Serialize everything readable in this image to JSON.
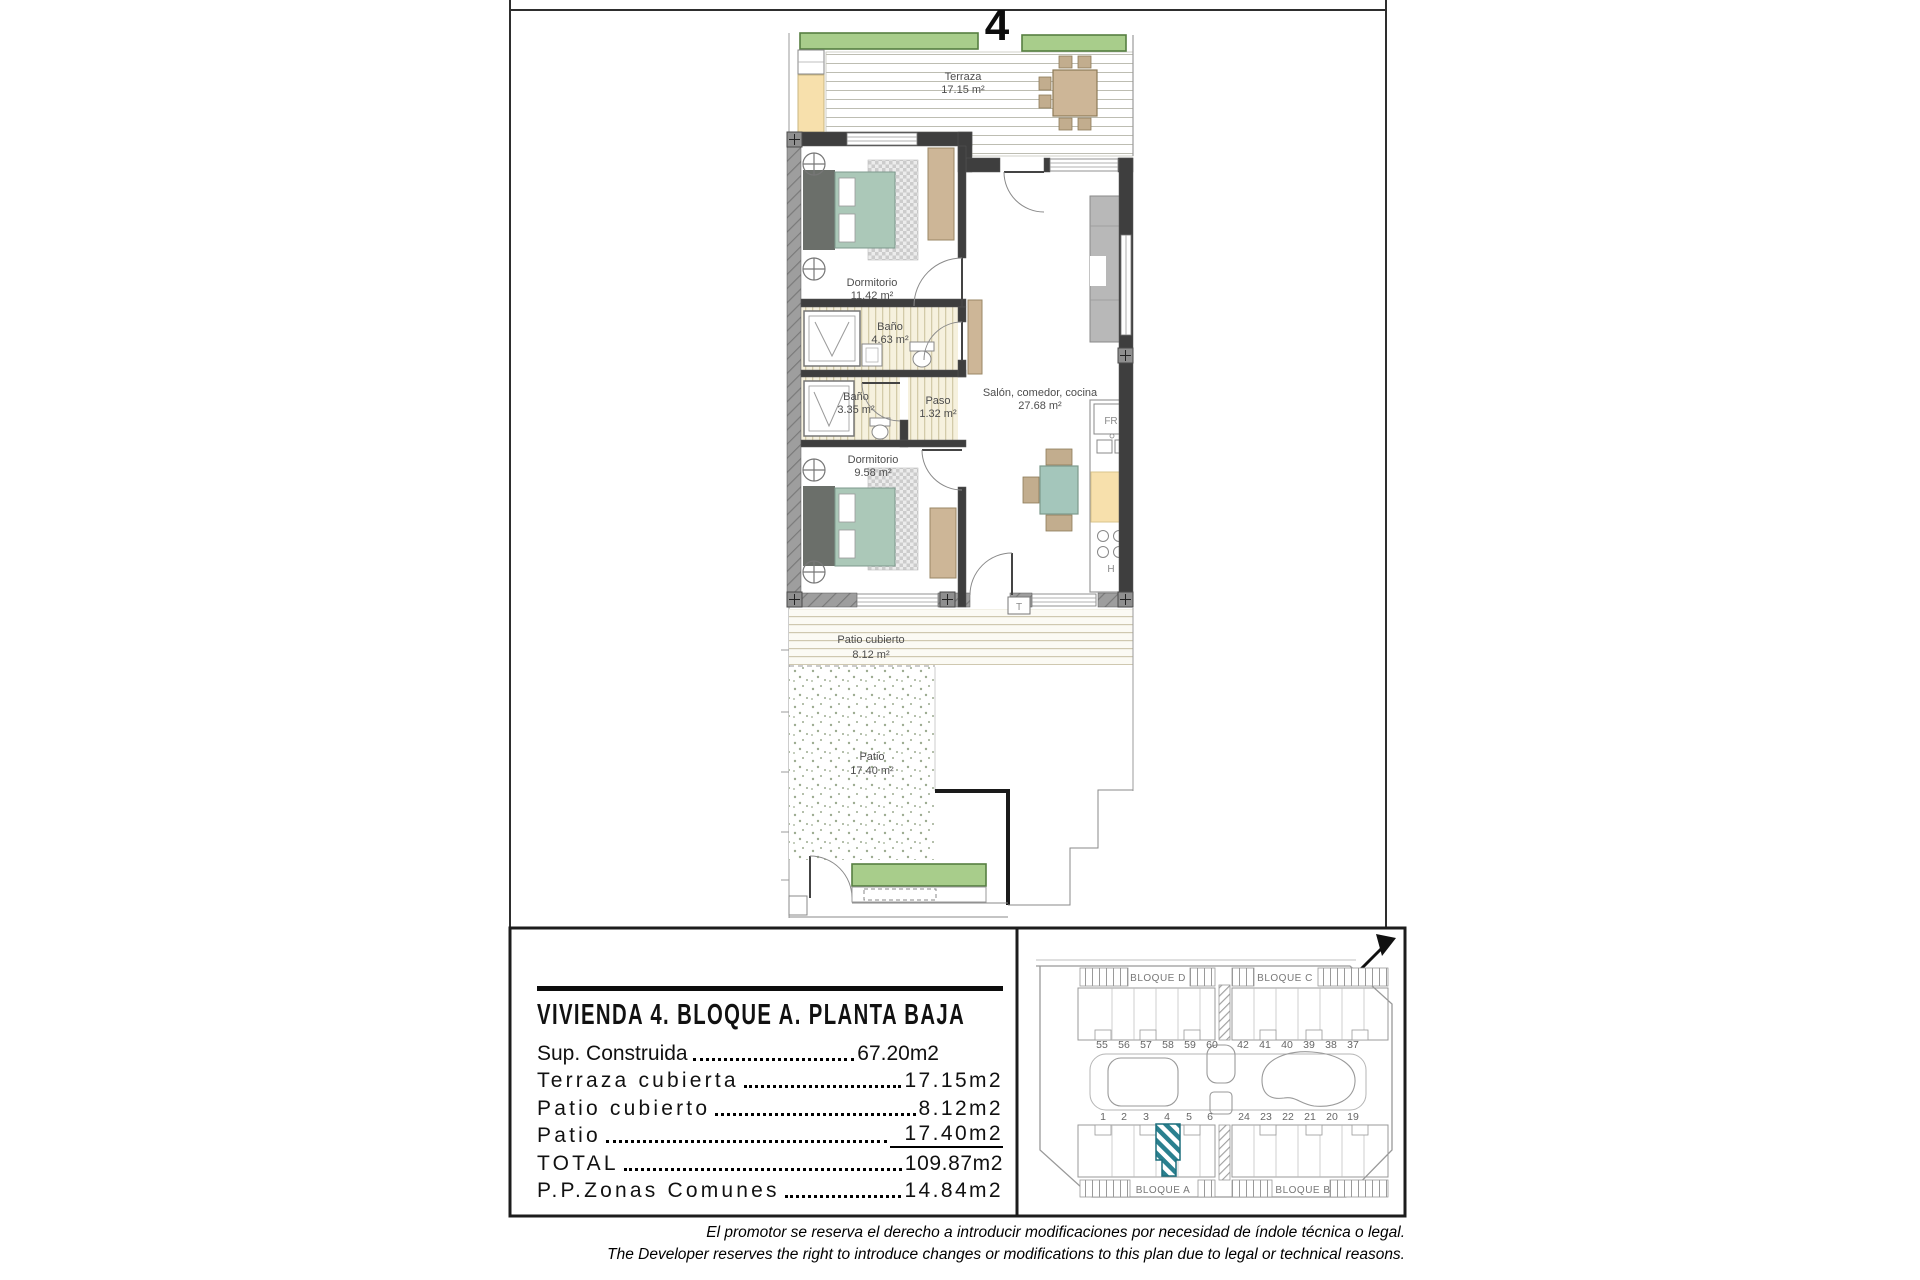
{
  "sheet": {
    "unit_number": "4"
  },
  "floorplan": {
    "terraza": {
      "name": "Terraza",
      "area": "17.15 m²"
    },
    "dorm1": {
      "name": "Dormitorio",
      "area": "11.42 m²"
    },
    "bano1": {
      "name": "Baño",
      "area": "4.63 m²"
    },
    "bano2": {
      "name": "Baño",
      "area": "3.35 m²"
    },
    "paso": {
      "name": "Paso",
      "area": "1.32 m²"
    },
    "salon": {
      "name": "Salón, comedor, cocina",
      "area": "27.68 m²"
    },
    "dorm2": {
      "name": "Dormitorio",
      "area": "9.58 m²"
    },
    "patio_cubierto": {
      "name": "Patio cubierto",
      "area": "8.12 m²"
    },
    "patio": {
      "name": "Patio",
      "area": "17.40 m²"
    },
    "labels": {
      "fridge": "FR",
      "hob": "H",
      "tank": "T"
    }
  },
  "summary": {
    "title": "VIVIENDA 4. BLOQUE A. PLANTA BAJA",
    "rows": [
      {
        "label": "Sup. Construida",
        "value": "67.20m2"
      },
      {
        "label": "Terraza cubierta",
        "value": "17.15m2"
      },
      {
        "label": "Patio cubierto",
        "value": "8.12m2"
      },
      {
        "label": "Patio",
        "value": "17.40m2"
      },
      {
        "label": "TOTAL",
        "value": "109.87m2"
      },
      {
        "label": "P.P.Zonas Comunes",
        "value": "14.84m2"
      }
    ]
  },
  "siteplan": {
    "blocks": {
      "top_left": "BLOQUE D",
      "top_right": "BLOQUE C",
      "bottom_left": "BLOQUE A",
      "bottom_right": "BLOQUE B"
    },
    "units_top_left": [
      "55",
      "56",
      "57",
      "58",
      "59",
      "60"
    ],
    "units_top_right": [
      "42",
      "41",
      "40",
      "39",
      "38",
      "37"
    ],
    "units_bottom_left": [
      "1",
      "2",
      "3",
      "4",
      "5",
      "6"
    ],
    "units_bottom_right": [
      "24",
      "23",
      "22",
      "21",
      "20",
      "19"
    ],
    "highlight_unit": "4"
  },
  "footer": {
    "disclaimer_es": "El promotor se reserva el derecho a introducir modificaciones por necesidad de índole técnica o legal.",
    "disclaimer_en": "The Developer reserves the right to introduce changes or modifications to this plan due to legal or technical reasons."
  },
  "colors": {
    "wall": "#3e3e3e",
    "bed": "#abc8b8",
    "wood": "#cdb697",
    "hedge": "#a8cd8b",
    "planter": "#f7e0ac",
    "highlight": "#2a808f"
  }
}
